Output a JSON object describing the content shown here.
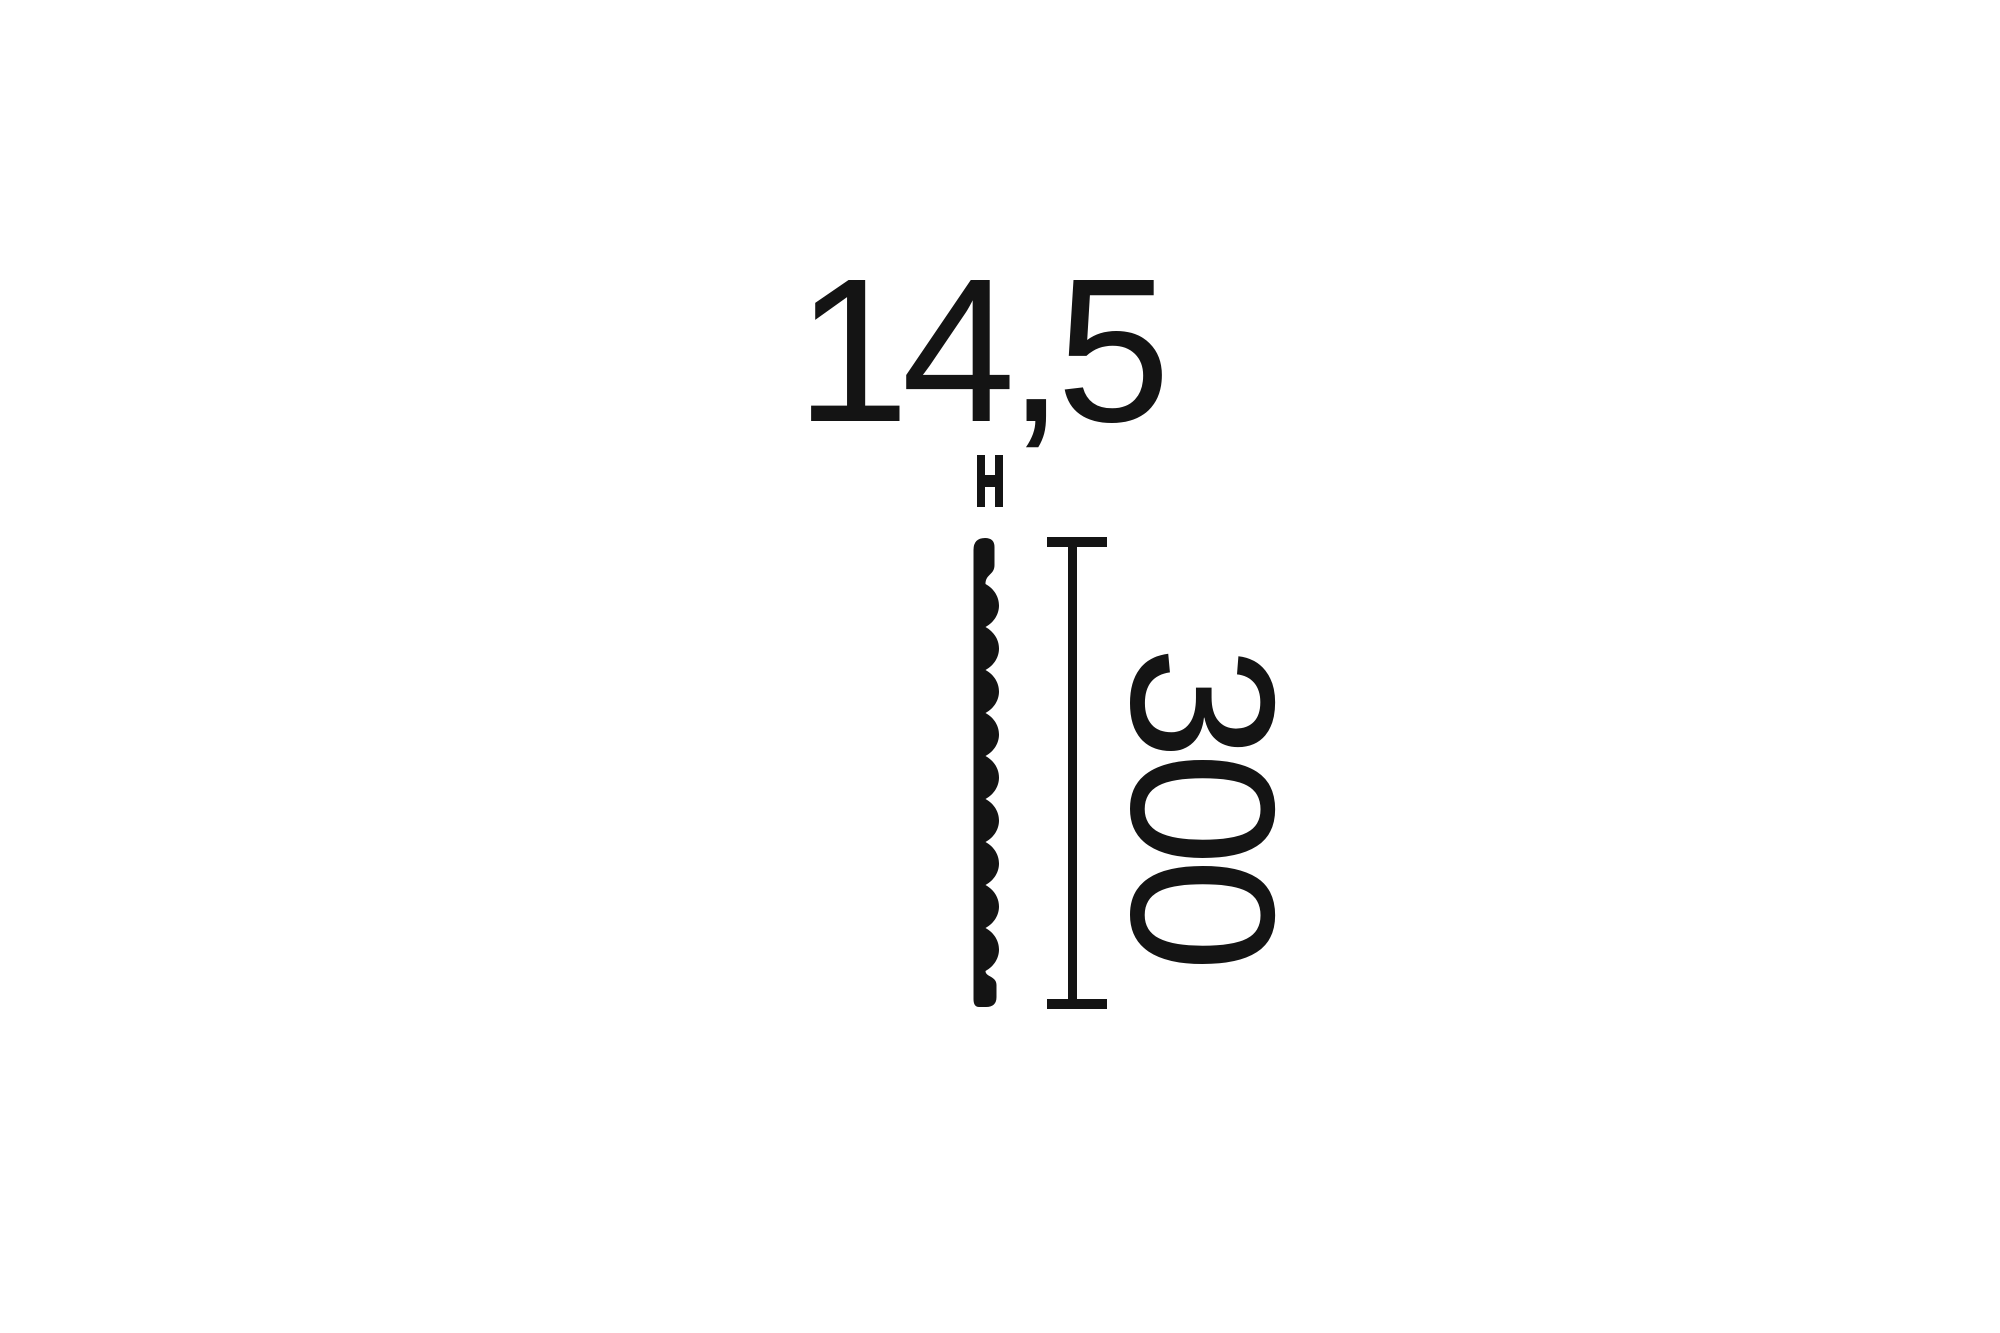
{
  "page": {
    "background_color": "#ffffff",
    "ink_color": "#141414"
  },
  "diagram": {
    "type": "profile cross-section dimension drawing",
    "width_label": "14,5",
    "height_label": "300",
    "dimensions": {
      "width_value": "14,5",
      "height_value": "300"
    }
  }
}
